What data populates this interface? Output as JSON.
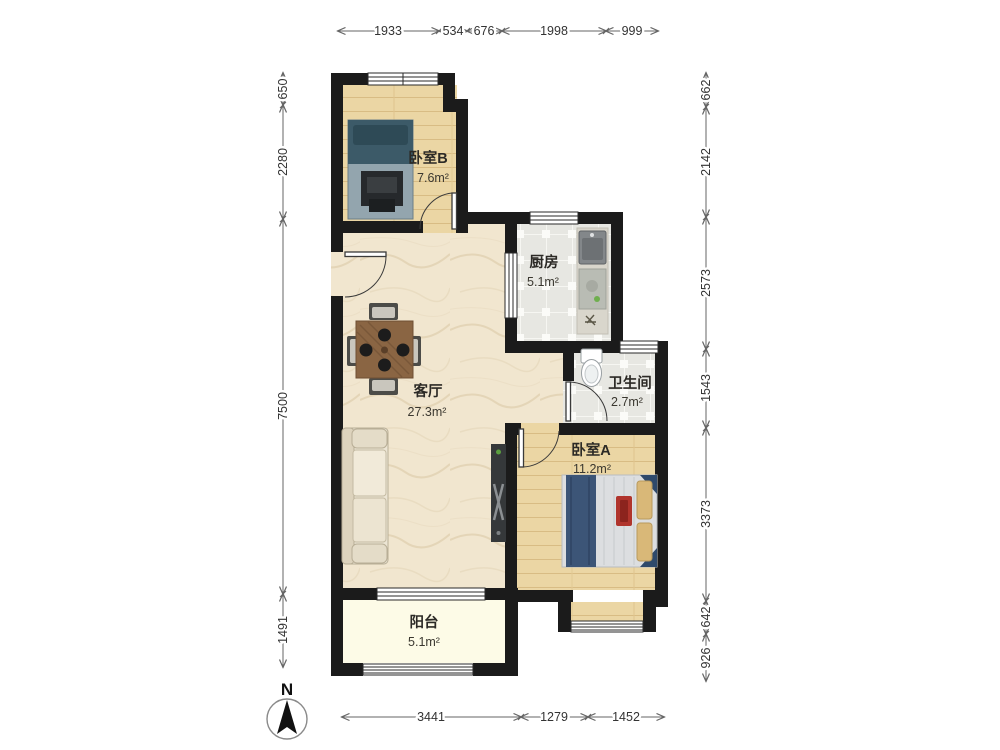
{
  "compass": {
    "label": "N"
  },
  "rooms": {
    "bedroom_b": {
      "name": "卧室B",
      "area": "7.6m²"
    },
    "kitchen": {
      "name": "厨房",
      "area": "5.1m²"
    },
    "living": {
      "name": "客厅",
      "area": "27.3m²"
    },
    "bathroom": {
      "name": "卫生间",
      "area": "2.7m²"
    },
    "bedroom_a": {
      "name": "卧室A",
      "area": "11.2m²"
    },
    "balcony": {
      "name": "阳台",
      "area": "5.1m²"
    }
  },
  "dims": {
    "top": [
      "1933",
      "534",
      "676",
      "1998",
      "999"
    ],
    "left": [
      "650",
      "2280",
      "7500",
      "1491"
    ],
    "right": [
      "662",
      "2142",
      "2573",
      "1543",
      "3373",
      "642",
      "926"
    ],
    "bottom": [
      "3441",
      "1279",
      "1452"
    ]
  },
  "colors": {
    "wall": "#1b1b1b",
    "wood_floor": "#ebd6a4",
    "marble_floor": "#f1e6cf",
    "tile_floor": "#e7e7e2",
    "balcony_floor": "#fdfbe7",
    "bed_blue": "#3c5577",
    "bed_teal": "#3c5a68",
    "dim_line": "#666666"
  }
}
